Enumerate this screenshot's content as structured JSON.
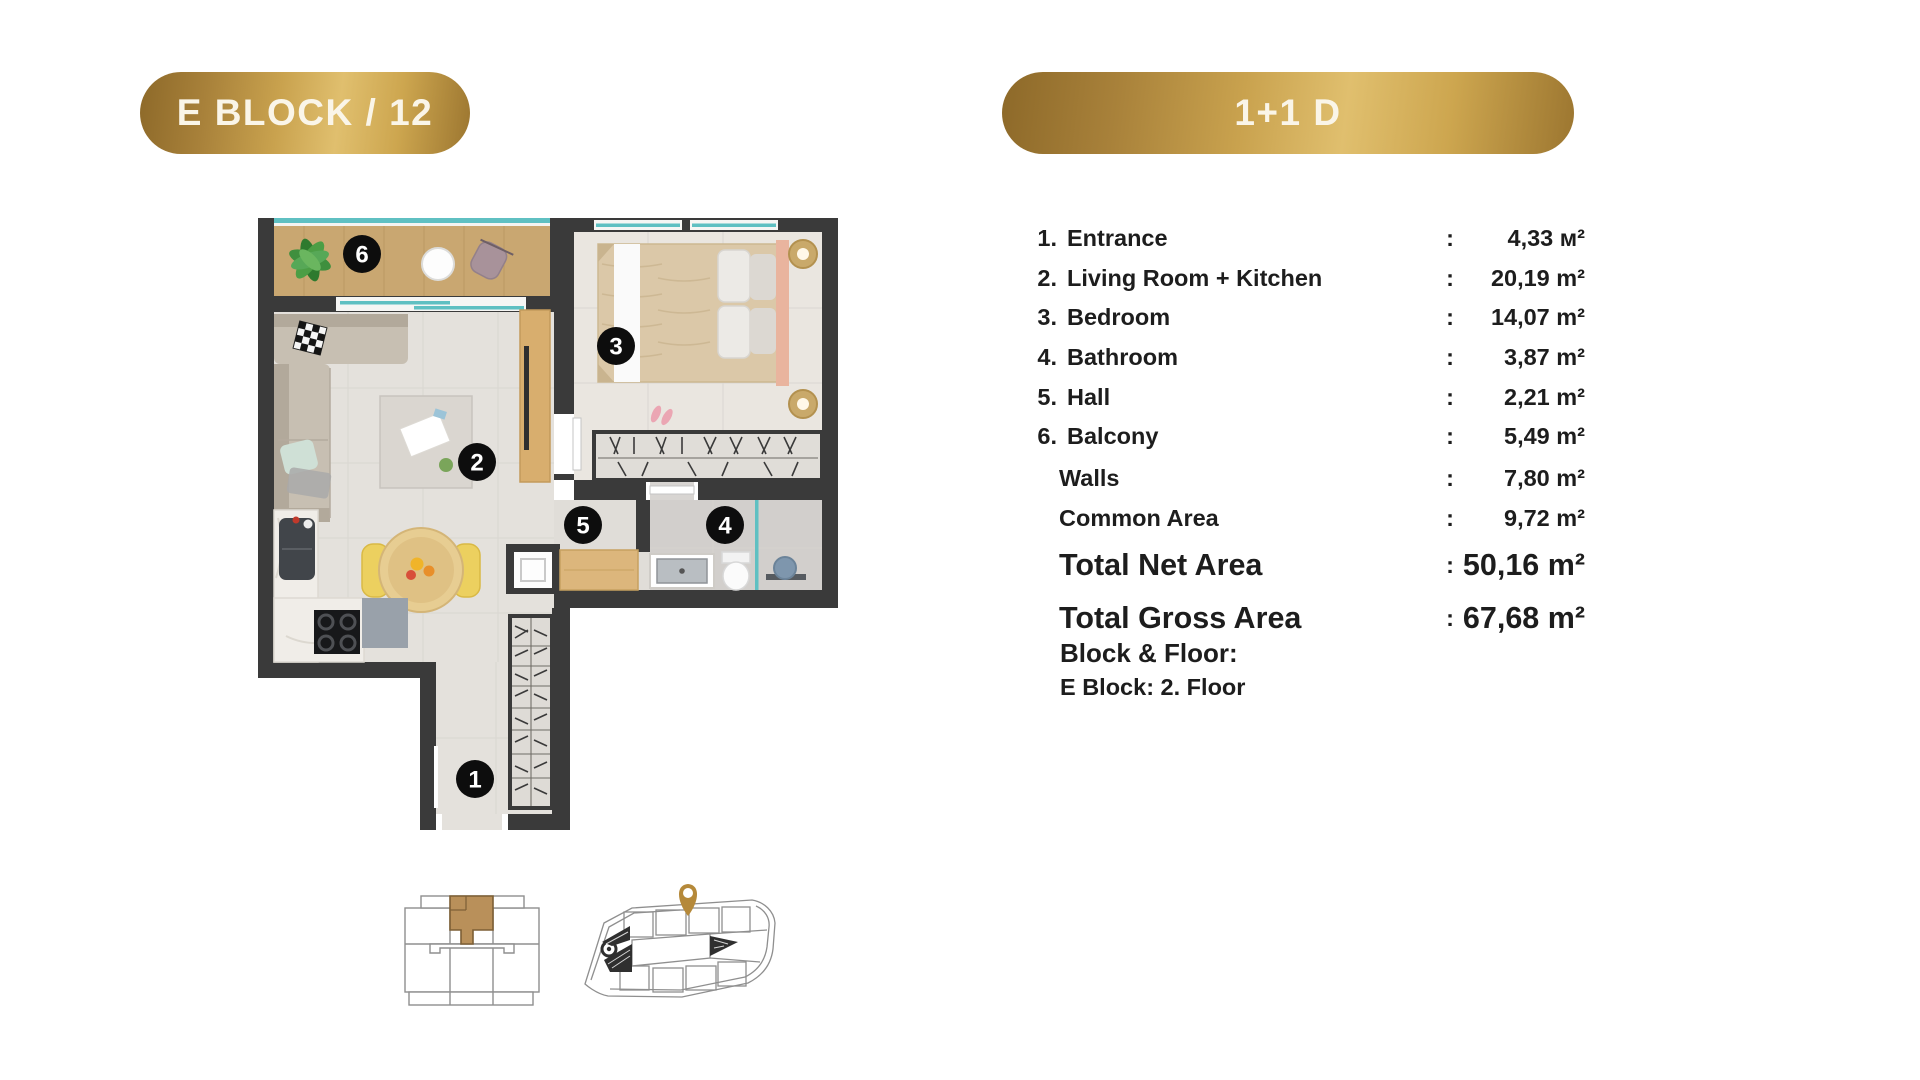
{
  "header": {
    "left_badge": "E BLOCK / 12",
    "right_badge": "1+1 D"
  },
  "plan": {
    "markers": [
      {
        "number": "1"
      },
      {
        "number": "2"
      },
      {
        "number": "3"
      },
      {
        "number": "4"
      },
      {
        "number": "5"
      },
      {
        "number": "6"
      }
    ]
  },
  "area_table": {
    "rows": [
      {
        "num": "1.",
        "label": "Entrance",
        "colon": ":",
        "value": "4,33 м²"
      },
      {
        "num": "2.",
        "label": "Living Room + Kitchen",
        "colon": ":",
        "value": "20,19 m²"
      },
      {
        "num": "3.",
        "label": "Bedroom",
        "colon": ":",
        "value": "14,07 m²"
      },
      {
        "num": "4.",
        "label": "Bathroom",
        "colon": ":",
        "value": "3,87 m²"
      },
      {
        "num": "5.",
        "label": "Hall",
        "colon": ":",
        "value": "2,21 m²"
      },
      {
        "num": "6.",
        "label": "Balcony",
        "colon": ":",
        "value": "5,49 m²"
      }
    ],
    "sub_rows": [
      {
        "label": "Walls",
        "colon": ":",
        "value": "7,80 m²"
      },
      {
        "label": "Common Area",
        "colon": ":",
        "value": "9,72 m²"
      }
    ],
    "total_rows": [
      {
        "label": "Total Net Area",
        "colon": ":",
        "value": "50,16 m²"
      },
      {
        "label": "Total Gross Area",
        "colon": ":",
        "value": "67,68 m²"
      }
    ],
    "block_floor": {
      "title": "Block & Floor:",
      "value": "E Block: 2. Floor"
    }
  },
  "colors": {
    "gold_dark": "#8d6929",
    "gold_light": "#e0bf6e",
    "wall": "#3a3a3a",
    "glass_teal": "#5fc0c2",
    "balcony_wood": "#c9a771",
    "floor_main": "#e4e1dc",
    "floor_bedroom": "#eae6e0",
    "floor_bath": "#d2cfcc",
    "pin_gold": "#b5893a",
    "text": "#1d1d1d"
  }
}
